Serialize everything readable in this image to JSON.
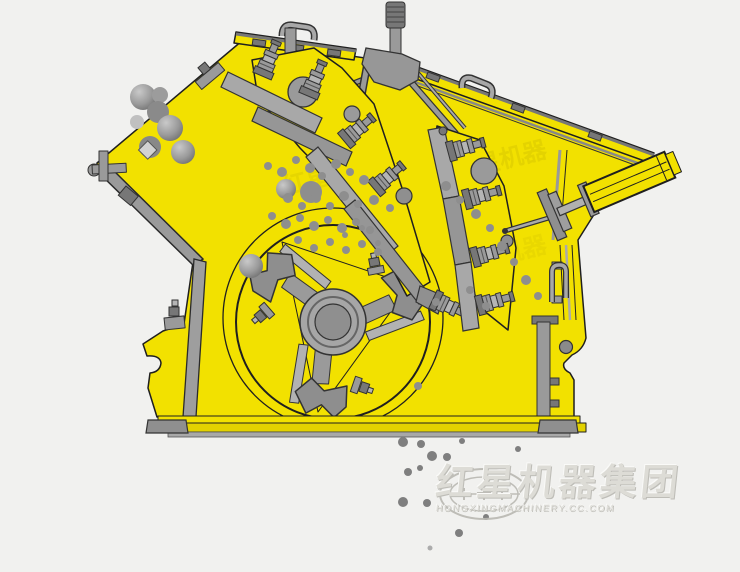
{
  "colors": {
    "bg": "#f1f1ef",
    "yellow": "#f2e100",
    "yellowDark": "#e3d200",
    "line": "#1f1f1f",
    "metal": "#9a9a9a",
    "metalLight": "#b5b5b5",
    "metalDark": "#777777",
    "particle": "#8e8e8e",
    "wmText": "#dbdad4",
    "wmShadow": "#b9b8b2"
  },
  "watermark": {
    "cn": "红星机器集团",
    "en": "HONGXINGMACHINERY.CC.COM"
  },
  "inner_watermark": {
    "text": "红星机器"
  }
}
